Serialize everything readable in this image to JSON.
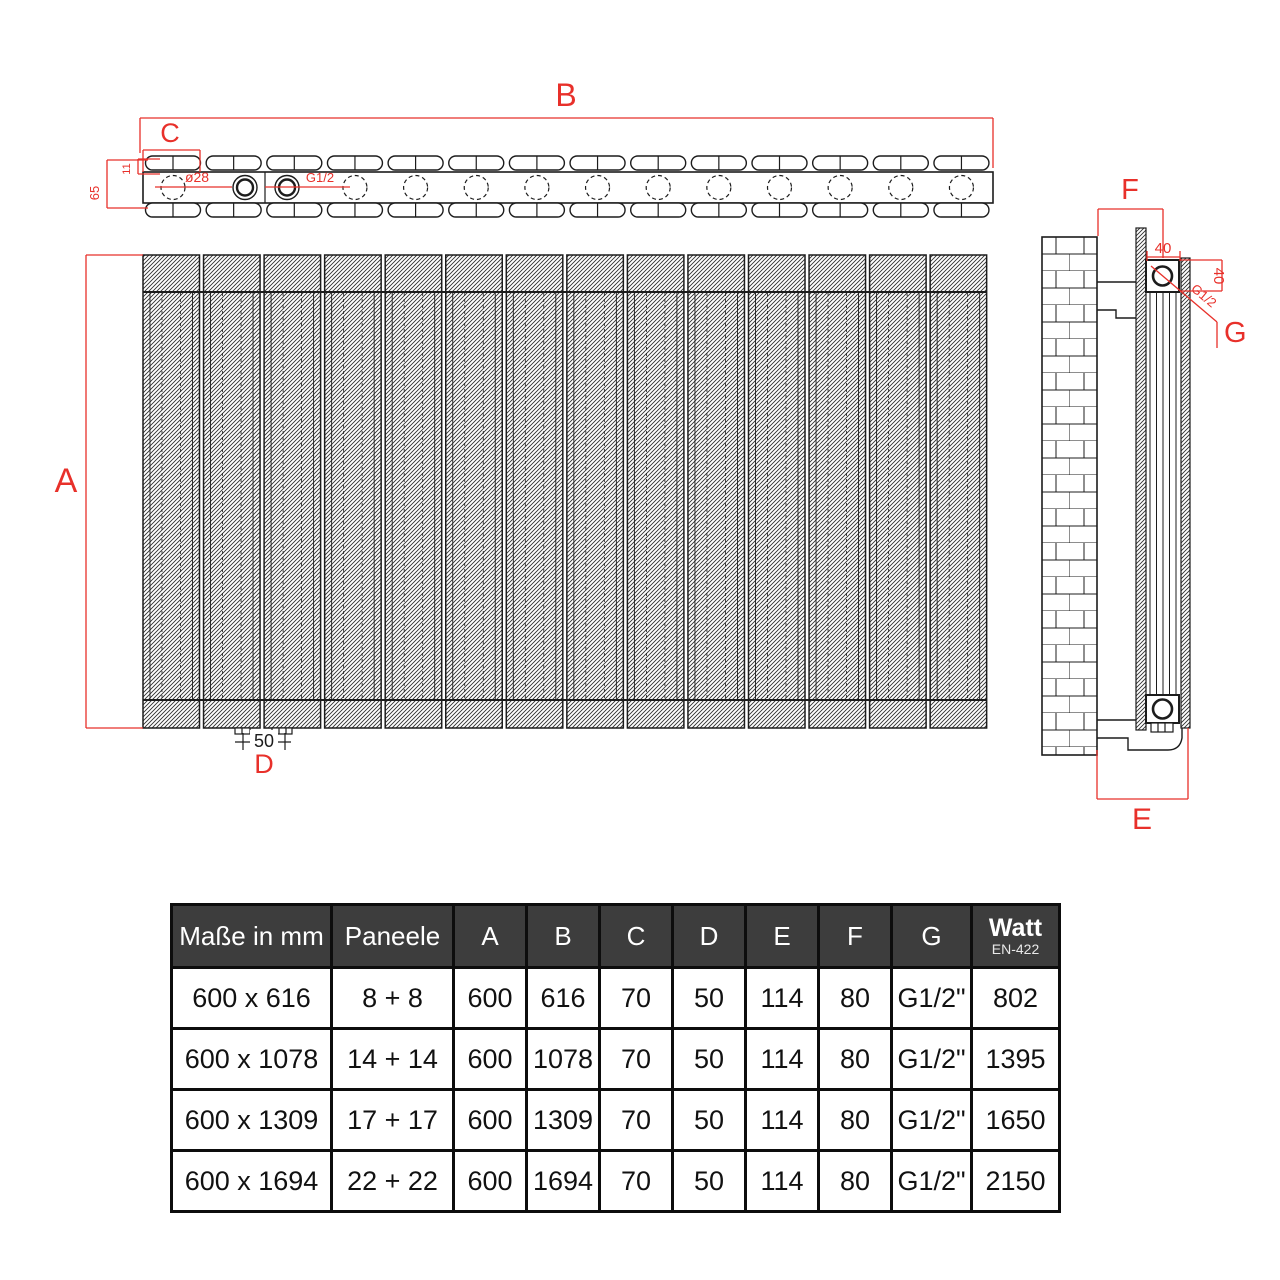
{
  "colors": {
    "red": "#e8302a",
    "line": "#1c1c1c",
    "table_header_bg": "#3d3d3d",
    "table_header_text": "#ffffff"
  },
  "drawing": {
    "top_view": {
      "dim_b": "B",
      "dim_c": "C",
      "dim_depth": "65",
      "dim_panel_height": "11",
      "hole_dia": "ø28",
      "thread": "G1/2",
      "tube_count": 14
    },
    "front_view": {
      "dim_a": "A",
      "dim_foot_spacing": "50",
      "dim_d": "D",
      "panels_drawn": 14
    },
    "side_view": {
      "dim_f": "F",
      "dim_40_top": "40",
      "dim_40_right": "40",
      "thread": "G1/2",
      "dim_g": "G",
      "dim_e": "E",
      "profile_lines": 5
    }
  },
  "table": {
    "columns": [
      "Maße in mm",
      "Paneele",
      "A",
      "B",
      "C",
      "D",
      "E",
      "F",
      "G"
    ],
    "watt_column": {
      "title": "Watt",
      "subtitle": "EN-422"
    },
    "rows": [
      [
        "600 x 616",
        "8 + 8",
        "600",
        "616",
        "70",
        "50",
        "114",
        "80",
        "G1/2\"",
        "802"
      ],
      [
        "600 x 1078",
        "14 + 14",
        "600",
        "1078",
        "70",
        "50",
        "114",
        "80",
        "G1/2\"",
        "1395"
      ],
      [
        "600 x 1309",
        "17 + 17",
        "600",
        "1309",
        "70",
        "50",
        "114",
        "80",
        "G1/2\"",
        "1650"
      ],
      [
        "600 x 1694",
        "22 + 22",
        "600",
        "1694",
        "70",
        "50",
        "114",
        "80",
        "G1/2\"",
        "2150"
      ]
    ]
  }
}
